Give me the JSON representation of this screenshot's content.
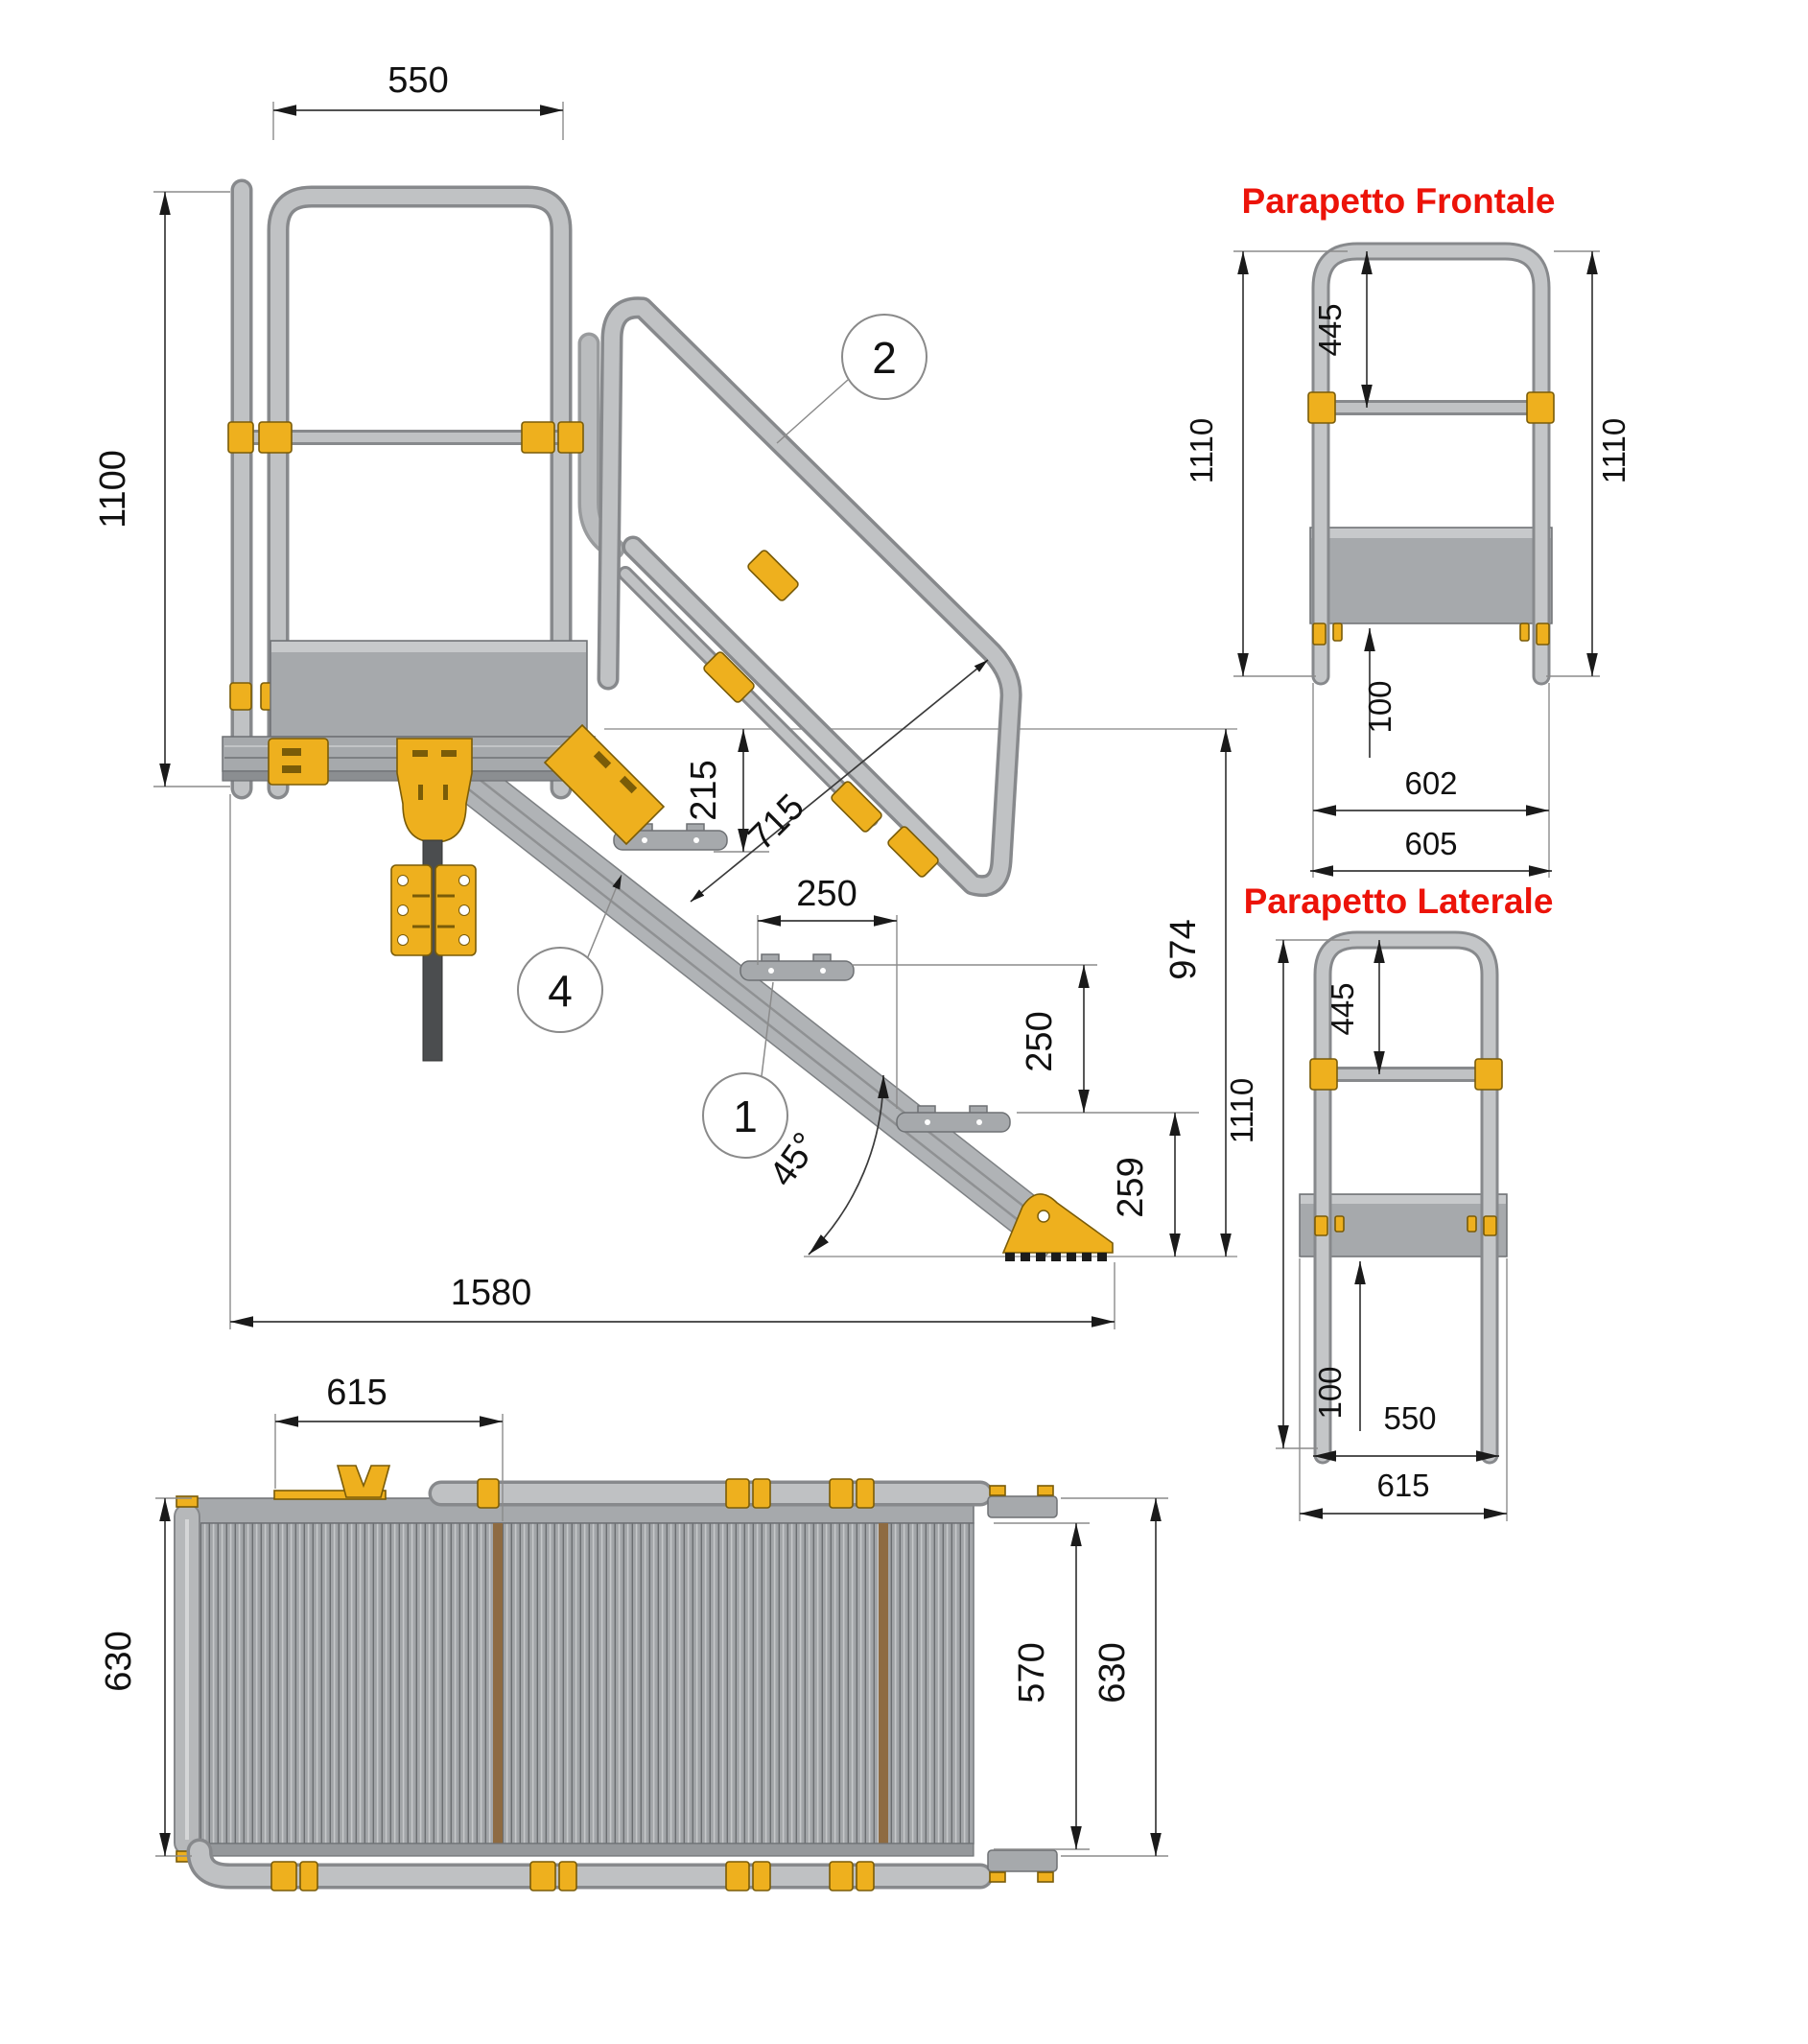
{
  "drawing": {
    "kind": "technical-drawing",
    "subject": "access platform with stair and guardrails",
    "language": "it"
  },
  "colors": {
    "tube_gray": "#c0c2c4",
    "tube_edge": "#87898c",
    "panel_gray": "#a6a9ac",
    "accent_yellow": "#eeb01e",
    "accent_yellow_edge": "#7a5c08",
    "dark_post": "#4b4d4f",
    "deck_brown": "#8e6b42",
    "dimension_text": "#111111",
    "title_red": "#ec1309"
  },
  "main_view": {
    "callouts": [
      {
        "n": "2"
      },
      {
        "n": "1"
      },
      {
        "n": "4"
      }
    ],
    "dims": {
      "w550": "550",
      "h1100": "1100",
      "d215": "215",
      "d715": "715",
      "run250": "250",
      "rise250": "250",
      "d259": "259",
      "h974": "974",
      "angle": "45°",
      "len1580": "1580"
    }
  },
  "front_parapet": {
    "title": "Parapetto Frontale",
    "dims": {
      "d445": "445",
      "left1110": "1110",
      "right1110": "1110",
      "d100": "100",
      "d602": "602",
      "d605": "605"
    }
  },
  "side_parapet": {
    "title": "Parapetto Laterale",
    "dims": {
      "d445": "445",
      "d1110": "1110",
      "d100": "100",
      "d550": "550",
      "d615": "615"
    }
  },
  "plan_view": {
    "dims": {
      "d615": "615",
      "left630": "630",
      "d570": "570",
      "right630": "630"
    }
  }
}
